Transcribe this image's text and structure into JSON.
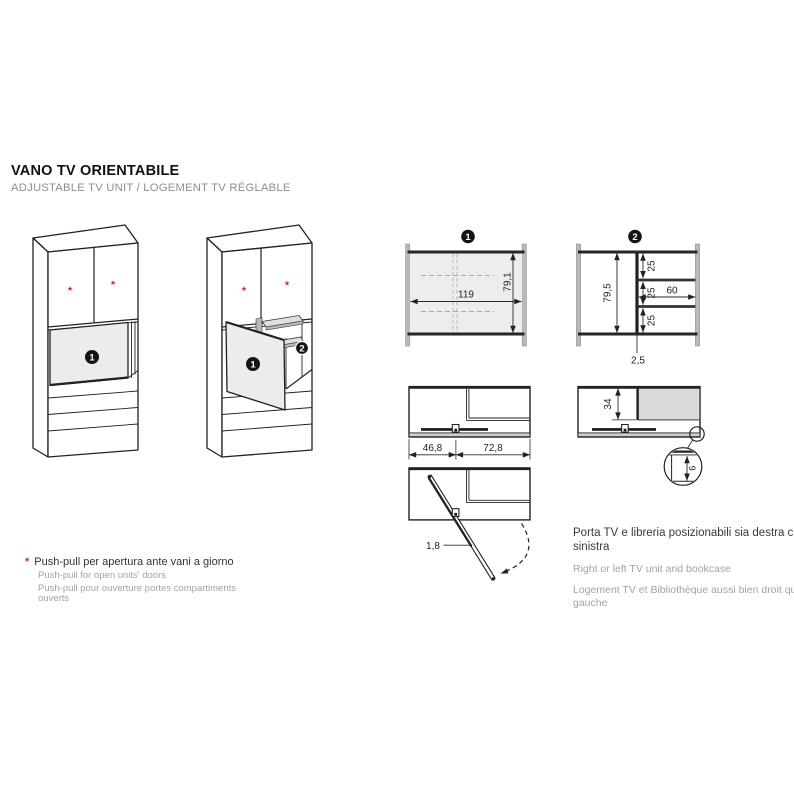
{
  "header": {
    "title": "VANO TV ORIENTABILE",
    "subtitle": "ADJUSTABLE TV UNIT / LOGEMENT TV RÉGLABLE"
  },
  "badges": {
    "tv_unit": "1",
    "bookcase": "2"
  },
  "symbols": {
    "push_pull_star": "★",
    "footnote_marker": "*"
  },
  "drawing1": {
    "badge": "1",
    "inner_width": "119",
    "inner_height": "79,1"
  },
  "drawing2": {
    "badge": "2",
    "left_height": "79,5",
    "cell_top": "25",
    "cell_middle": "25",
    "cell_bottom": "25",
    "shelf_width": "60",
    "divider_thickness": "2,5"
  },
  "plan_view": {
    "tv_bay_width": "46,8",
    "bookcase_width": "72,8"
  },
  "side_view": {
    "tv_panel_height": "34",
    "edge_gap": "6"
  },
  "swivel_view": {
    "panel_thickness": "1,8"
  },
  "note": {
    "it": "Porta TV e libreria posizionabili sia destra che sinistra",
    "en": "Right or left TV unit and bookcase",
    "fr": "Logement TV et Bibliothèque aussi bien droit que gauche"
  },
  "footnote": {
    "it": "Push-pull per apertura ante vani a giorno",
    "en": "Push-pull for open units' doors",
    "fr": "Push-pull pour ouverture portes compartiments ouverts"
  },
  "colors": {
    "accent_red": "#c5303c",
    "line_dark": "#222222",
    "panel_gray": "#ececec",
    "shade_gray": "#dadada"
  }
}
